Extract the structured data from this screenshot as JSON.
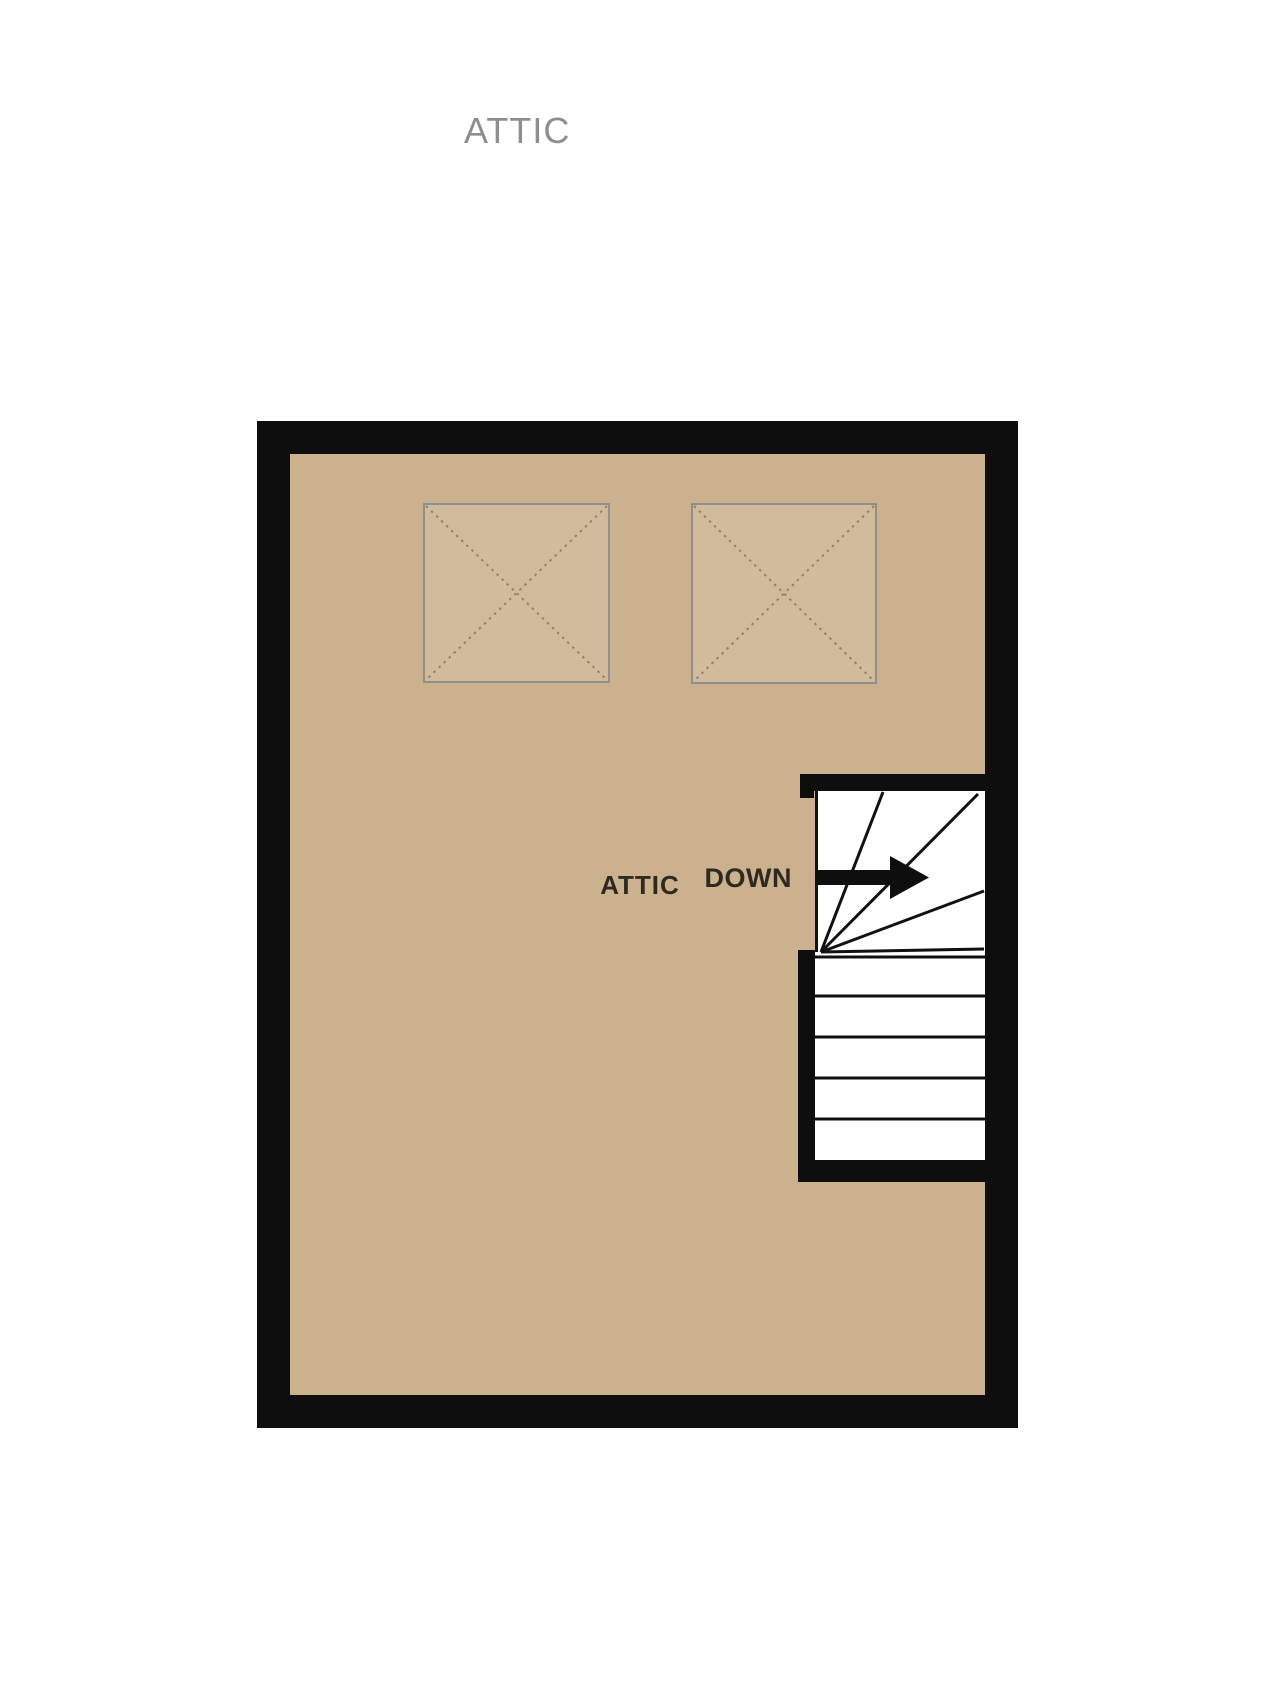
{
  "page": {
    "title": "ATTIC"
  },
  "plan": {
    "room_label": "ATTIC",
    "stair_label": "DOWN"
  },
  "colors": {
    "page_bg": "#ffffff",
    "floor": "#cbb18e",
    "wall": "#0e0e0e",
    "stair_bg": "#ffffff",
    "stair_line": "#111111",
    "skylight_fill": "#d2bb9b",
    "skylight_border": "#8f8f8f",
    "skylight_dash": "#8d8271",
    "title_text": "#8e8e8e",
    "label_text": "#2e2a20"
  }
}
